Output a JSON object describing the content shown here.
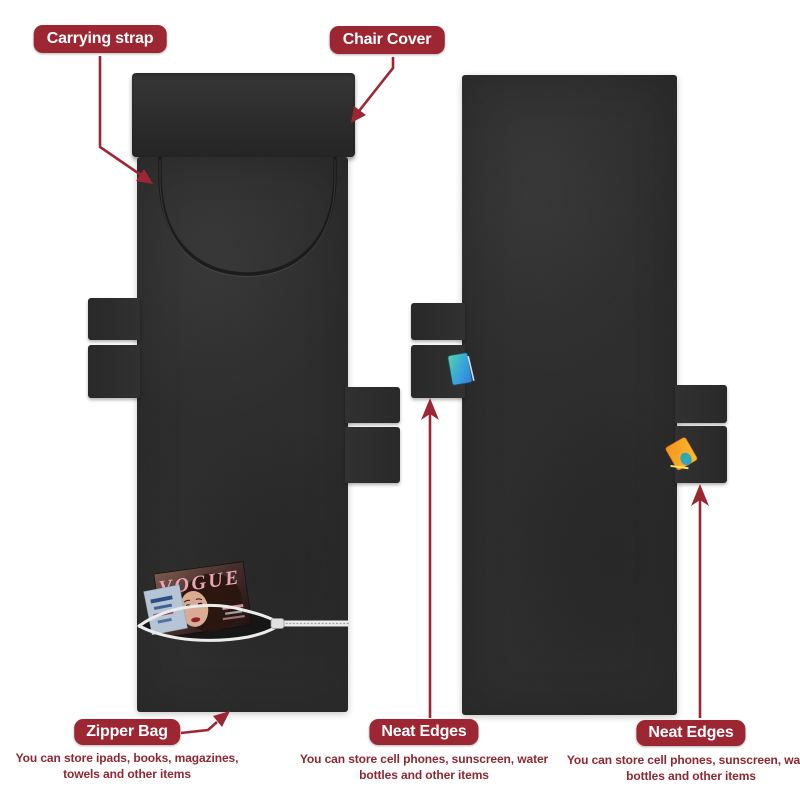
{
  "image": {
    "kind": "annotated product infographic",
    "subject": "black lounge chair cover with storage pockets",
    "background": "#ffffff"
  },
  "colors": {
    "label_background": "#9c2733",
    "label_text": "#ffffff",
    "description_text": "#8e2733",
    "arrow": "#9c2733",
    "cover_fabric": "#2e2d2e",
    "zipper_tape": "#ececec",
    "phone_gradient": [
      "#54d6a8",
      "#2f7fe0"
    ],
    "sunscreen_gradient": [
      "#f6921e",
      "#fbc02d"
    ],
    "magazine_title_pink": "#eda4b6"
  },
  "callouts": {
    "carrying_strap": {
      "label": "Carrying strap"
    },
    "chair_cover": {
      "label": "Chair Cover"
    },
    "zipper_bag": {
      "label": "Zipper Bag",
      "description": "You can store ipads, books, magazines, towels and other items"
    },
    "neat_edges_left": {
      "label": "Neat Edges",
      "description": "You can store cell phones, sunscreen, water bottles and other items"
    },
    "neat_edges_right": {
      "label": "Neat Edges",
      "description": "You can store cell phones, sunscreen, water bottles and other items"
    }
  },
  "magazine": {
    "title": "VOGUE"
  }
}
